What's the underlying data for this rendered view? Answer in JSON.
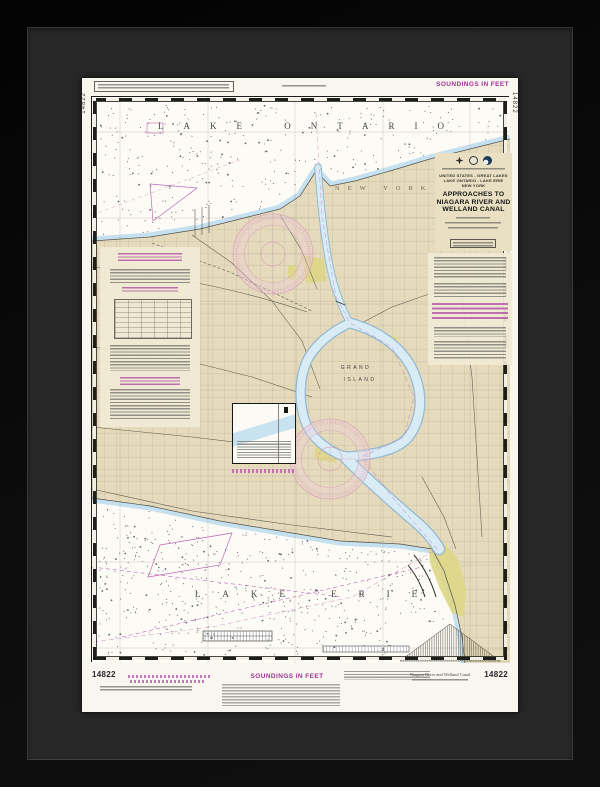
{
  "artwork": {
    "kind": "framed nautical chart print",
    "frame_color": "#0a0a0a",
    "matte_color": "#282828",
    "paper_color": "#f8f6ef"
  },
  "chart": {
    "number": "14822",
    "soundings_top": "SOUNDINGS IN FEET",
    "soundings_bottom": "SOUNDINGS IN FEET",
    "title_block": {
      "country": "UNITED STATES - GREAT LAKES",
      "lakes": "LAKE ONTARIO - LAKE ERIE",
      "state": "NEW YORK",
      "title1": "APPROACHES TO",
      "title2": "NIAGARA RIVER AND",
      "title3": "WELLAND CANAL"
    },
    "map_labels": {
      "lake_ontario": "LAKE ONTARIO",
      "lake_erie": "LAKE ERIE",
      "state_spread": "NEW YORK",
      "grand": "GRAND",
      "island": "ISLAND"
    },
    "footer": {
      "subtitle": "Niagara River and Welland Canal"
    },
    "colors": {
      "magenta_accent": "#a83a9b",
      "land_tan": "#e5dbbc",
      "water_fringe": "#c2deee",
      "river_blue": "#d9ecf6",
      "urban_yellow": "#ded786"
    }
  }
}
